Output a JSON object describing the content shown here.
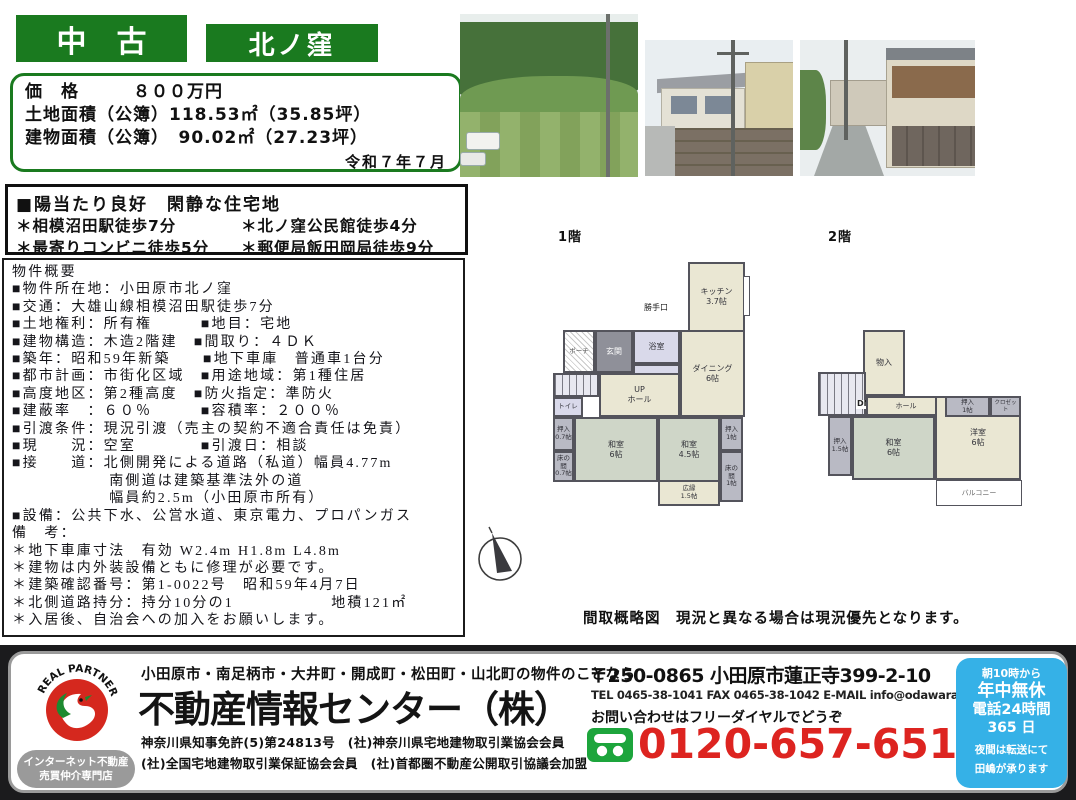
{
  "colors": {
    "brand_green": "#1a7a1f",
    "accent_red": "#dd2420",
    "hours_blue": "#35b1e7",
    "logo_red": "#d5281e",
    "logo_green": "#1d8a30",
    "freedial_green": "#1da53c"
  },
  "header": {
    "badge_used": "中　古",
    "badge_area": "北ノ窪"
  },
  "price_box": {
    "rows": [
      "価　格　　　８００万円",
      "土地面積（公簿）118.53㎡（35.85坪）",
      "建物面積（公簿）　90.02㎡（27.23坪）"
    ],
    "date": "令和７年７月"
  },
  "features": {
    "title": "■陽当たり良好　閑静な住宅地",
    "rows": [
      {
        "l": "＊相模沼田駅徒歩7分",
        "r": "＊北ノ窪公民館徒歩4分"
      },
      {
        "l": "＊最寄りコンビニ徒歩5分",
        "r": "＊郵便局飯田岡局徒歩9分"
      }
    ]
  },
  "details": {
    "title": "物件概要",
    "lines": [
      "■物件所在地：小田原市北ノ窪",
      "■交通：大雄山線相模沼田駅徒歩7分",
      "■土地権利：所有権　　　■地目：宅地",
      "■建物構造：木造2階建　■間取り：４ＤＫ",
      "■築年：昭和59年新築　　■地下車庫　普通車1台分",
      "■都市計画：市街化区域　■用途地域：第1種住居",
      "■高度地区：第2種高度　■防火指定：準防火",
      "■建蔽率　：６０％　　　■容積率：２００％",
      "■引渡条件：現況引渡（売主の契約不適合責任は免責）",
      "■現　　況：空室　　　　■引渡日：相談",
      "■接　　道：北側開発による道路（私道）幅員4.77m",
      "　　　　　　南側道は建築基準法外の道",
      "　　　　　　幅員約2.5m（小田原市所有）",
      "■設備：公共下水、公営水道、東京電力、プロパンガス",
      "備　考：",
      "＊地下車庫寸法　有効 W2.4m H1.8m L4.8m",
      "＊建物は内外装設備ともに修理が必要です。",
      "＊建築確認番号：第1-0022号　昭和59年4月7日",
      "＊北側道路持分：持分10分の1　　　　　　地積121㎡",
      "＊入居後、自治会への加入をお願いします。"
    ]
  },
  "floorplans": {
    "f1_label": "1階",
    "f2_label": "2階",
    "caption": [
      "間取概略図　現況と異なる場合は現況優先となります。",
      "付近案内図は別紙参照お願いします。"
    ],
    "f1": {
      "kitchen": "キッチン\n3.7帖",
      "backdoor": "勝手口",
      "dining": "ダイニング\n6帖",
      "bath": "浴室",
      "washroom": "洗面所",
      "entrance": "玄関",
      "porch": "ポーチ",
      "hall": "UP\nホール",
      "toilet": "トイレ",
      "closet_left": "押入\n0.7帖",
      "tokonoma_left": "床の間\n0.7帖",
      "washitsu_6": "和室\n6帖",
      "washitsu_45": "和室\n4.5帖",
      "closet_right": "押入\n1帖",
      "tokonoma_right": "床の間\n1帖",
      "hiroen": "広縁\n1.5帖"
    },
    "f2": {
      "storage": "物入",
      "dn": "DN",
      "hall": "ホール",
      "closet_top": "押入\n1帖",
      "closet2": "クロゼット",
      "closet_left": "押入\n1.5帖",
      "washitsu": "和室\n6帖",
      "youshitsu": "洋室\n6帖",
      "balcony": "バルコニー"
    }
  },
  "footer": {
    "logo_text": "REAL PARTNER",
    "badge_lines": [
      "インターネット不動産",
      "売買仲介専門店"
    ],
    "tagline": "小田原市・南足柄市・大井町・開成町・松田町・山北町の物件のことなら",
    "company": "不動産情報センター（株）",
    "license1": "神奈川県知事免許(5)第24813号　(社)神奈川県宅地建物取引業協会会員",
    "license2": "(社)全国宅地建物取引業保証協会会員　(社)首都圏不動産公開取引協議会加盟",
    "address": "〒250-0865 小田原市蓮正寺399-2-10",
    "tel_line": "TEL 0465-38-1041 FAX 0465-38-1042 E-MAIL info@odawara1.co.jp",
    "inquiry": "お問い合わせはフリーダイヤルでどうぞ",
    "freedial": "0120-657-651",
    "hours": [
      "朝10時から",
      "年中無休",
      "電話24時間",
      "365 日",
      "夜間は転送にて",
      "田嶋が承ります"
    ]
  }
}
